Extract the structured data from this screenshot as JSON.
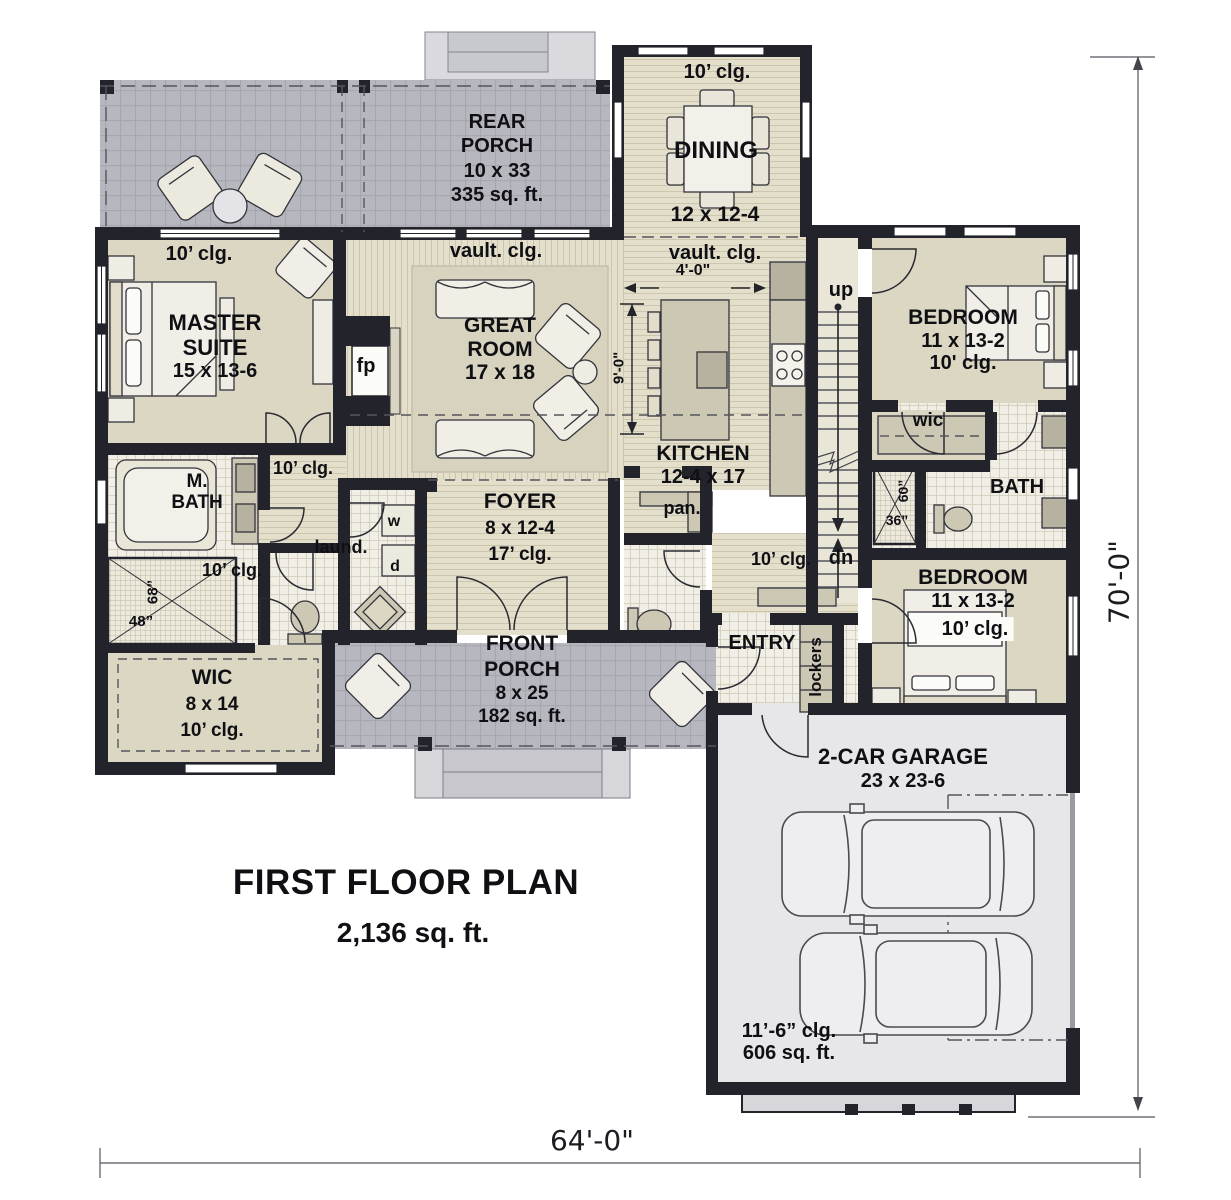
{
  "title": {
    "name": "FIRST FLOOR PLAN",
    "area": "2,136 sq. ft."
  },
  "overall_dims": {
    "width": "64'-0\"",
    "depth": "70'-0\""
  },
  "rooms": {
    "rear_porch": {
      "line1": "REAR",
      "line2": "PORCH",
      "dims": "10 x 33",
      "area": "335 sq. ft."
    },
    "dining": {
      "ceiling": "10’ clg.",
      "name": "DINING",
      "dims": "12 x 12-4"
    },
    "great_room": {
      "ceiling": "vault. clg.",
      "line1": "GREAT",
      "line2": "ROOM",
      "dims": "17 x 18"
    },
    "kitchen": {
      "ceiling": "vault. clg.",
      "island_offset": "4'-0\"",
      "name": "KITCHEN",
      "dims": "12-4 x 17",
      "island_depth": "9'-0\""
    },
    "master_suite": {
      "ceiling": "10’ clg.",
      "line1": "MASTER",
      "line2": "SUITE",
      "dims": "15 x 13-6"
    },
    "fireplace": {
      "label": "fp"
    },
    "master_bath": {
      "line1": "M.",
      "line2": "BATH",
      "ceiling": "10’ clg.",
      "shower_width": "68”",
      "shower_depth": "48”"
    },
    "hall_master": {
      "ceiling": "10’ clg."
    },
    "laundry": {
      "name": "laund.",
      "washer": "w",
      "dryer": "d"
    },
    "wic_master": {
      "name": "WIC",
      "dims": "8 x 14",
      "ceiling": "10’ clg."
    },
    "foyer": {
      "name": "FOYER",
      "dims": "8 x 12-4",
      "ceiling": "17’ clg."
    },
    "front_porch": {
      "line1": "FRONT",
      "line2": "PORCH",
      "dims": "8 x 25",
      "area": "182 sq. ft."
    },
    "pantry": {
      "name": "pan."
    },
    "entry": {
      "name": "ENTRY",
      "lockers": "lockers"
    },
    "hall_entry": {
      "ceiling": "10’ clg."
    },
    "stairs": {
      "up": "up",
      "down": "dn"
    },
    "bedroom2": {
      "name": "BEDROOM",
      "dims": "11 x 13-2",
      "ceiling": "10' clg."
    },
    "wic2": {
      "name": "wic"
    },
    "bath2": {
      "name": "BATH",
      "shower_width": "60”",
      "shower_depth": "36”"
    },
    "bedroom3": {
      "name": "BEDROOM",
      "dims": "11 x 13-2",
      "ceiling": "10’ clg."
    },
    "garage": {
      "name": "2-CAR GARAGE",
      "dims": "23 x 23-6",
      "ceiling": "11’-6” clg.",
      "area": "606 sq. ft."
    }
  },
  "colors": {
    "wall": "#23232b",
    "floor_tan": "#dcd7c2",
    "porch": "#b6b6be",
    "garage_floor": "#e7e7ea"
  }
}
